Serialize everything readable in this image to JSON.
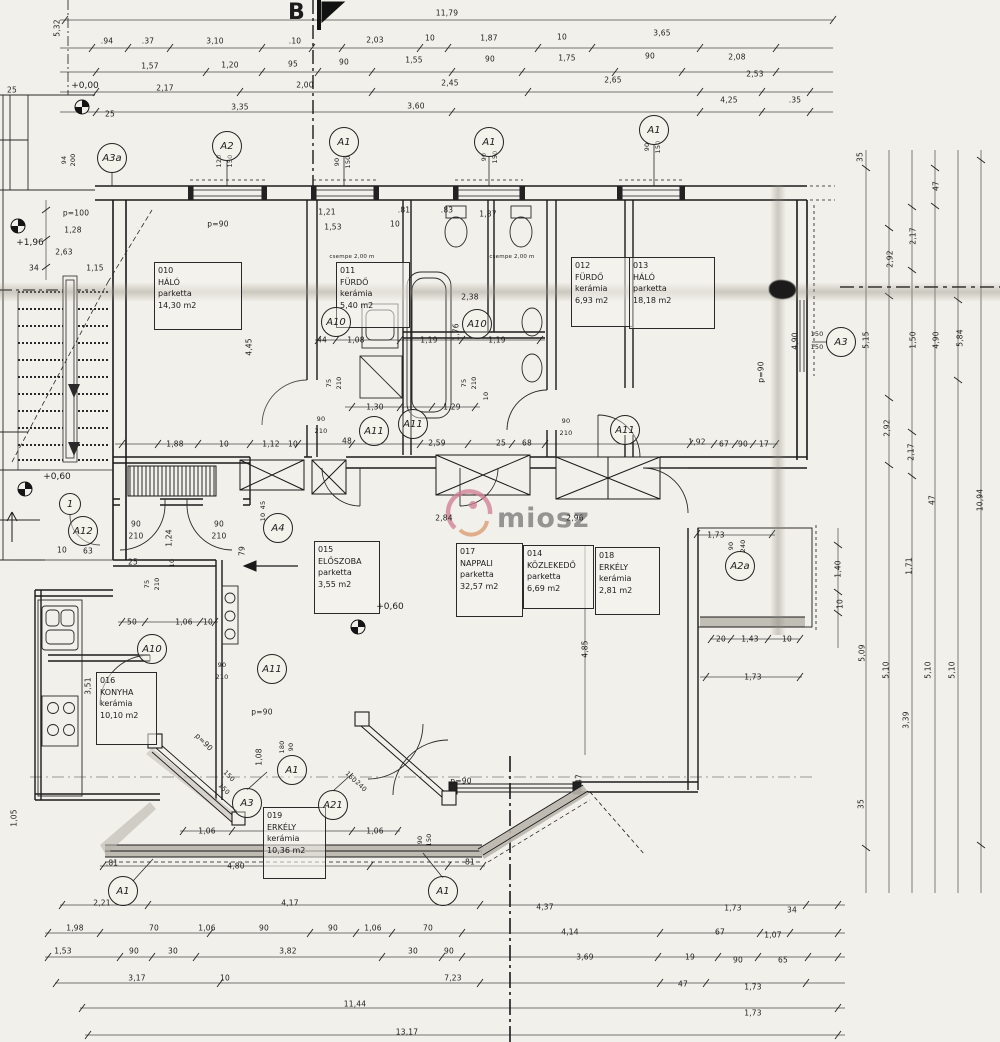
{
  "sheet": {
    "section_label": "B",
    "watermark_text": "miosz"
  },
  "rooms": [
    {
      "id": "010",
      "name": "HÁLÓ",
      "material": "parketta",
      "area": "14,30 m2",
      "x": 154,
      "y": 262,
      "w": 80,
      "h": 62
    },
    {
      "id": "011",
      "name": "FÜRDŐ",
      "material": "kerámia",
      "area": "5,40 m2",
      "x": 336,
      "y": 262,
      "w": 66,
      "h": 60
    },
    {
      "id": "012",
      "name": "FÜRDŐ",
      "material": "kerámia",
      "area": "6,93 m2",
      "x": 571,
      "y": 257,
      "w": 54,
      "h": 64
    },
    {
      "id": "013",
      "name": "HÁLÓ",
      "material": "parketta",
      "area": "18,18 m2",
      "x": 629,
      "y": 257,
      "w": 78,
      "h": 66
    },
    {
      "id": "015",
      "name": "ELŐSZOBA",
      "material": "parketta",
      "area": "3,55 m2",
      "x": 314,
      "y": 541,
      "w": 58,
      "h": 67
    },
    {
      "id": "017",
      "name": "NAPPALI",
      "material": "parketta",
      "area": "32,57 m2",
      "x": 456,
      "y": 543,
      "w": 59,
      "h": 68
    },
    {
      "id": "014",
      "name": "KÖZLEKEDŐ",
      "material": "parketta",
      "area": "6,69 m2",
      "x": 523,
      "y": 545,
      "w": 63,
      "h": 58
    },
    {
      "id": "018",
      "name": "ERKÉLY",
      "material": "kerámia",
      "area": "2,81 m2",
      "x": 595,
      "y": 547,
      "w": 57,
      "h": 62
    },
    {
      "id": "016",
      "name": "KONYHA",
      "material": "kerámia",
      "area": "10,10 m2",
      "x": 96,
      "y": 672,
      "w": 53,
      "h": 67
    },
    {
      "id": "019",
      "name": "ERKÉLY",
      "material": "kerámia",
      "area": "10,36 m2",
      "x": 263,
      "y": 807,
      "w": 55,
      "h": 66
    }
  ],
  "markers": [
    {
      "label": "A3a",
      "x": 112,
      "y": 158
    },
    {
      "label": "A2",
      "x": 227,
      "y": 146
    },
    {
      "label": "A1",
      "x": 344,
      "y": 142
    },
    {
      "label": "A1",
      "x": 489,
      "y": 142
    },
    {
      "label": "A1",
      "x": 654,
      "y": 130
    },
    {
      "label": "A3",
      "x": 841,
      "y": 342
    },
    {
      "label": "A10",
      "x": 336,
      "y": 322
    },
    {
      "label": "A10",
      "x": 477,
      "y": 324
    },
    {
      "label": "A11",
      "x": 374,
      "y": 431
    },
    {
      "label": "A11",
      "x": 413,
      "y": 424
    },
    {
      "label": "A11",
      "x": 625,
      "y": 430
    },
    {
      "label": "A10",
      "x": 152,
      "y": 649
    },
    {
      "label": "A11",
      "x": 272,
      "y": 669
    },
    {
      "label": "A12",
      "x": 83,
      "y": 531
    },
    {
      "label": "A4",
      "x": 278,
      "y": 528
    },
    {
      "label": "A2a",
      "x": 740,
      "y": 566
    },
    {
      "label": "1",
      "x": 70,
      "y": 504,
      "small": true
    },
    {
      "label": "A3",
      "x": 247,
      "y": 803
    },
    {
      "label": "A1",
      "x": 292,
      "y": 770
    },
    {
      "label": "A21",
      "x": 333,
      "y": 805
    },
    {
      "label": "A1",
      "x": 443,
      "y": 891
    },
    {
      "label": "A1",
      "x": 123,
      "y": 891
    }
  ],
  "levels": [
    {
      "text": "+0,00",
      "x": 85,
      "y": 86,
      "sx": 82,
      "sy": 107
    },
    {
      "text": "+1,96",
      "x": 30,
      "y": 243,
      "sx": 18,
      "sy": 226
    },
    {
      "text": "+0,60",
      "x": 57,
      "y": 477,
      "sx": 25,
      "sy": 489
    },
    {
      "text": "+0,60",
      "x": 390,
      "y": 607,
      "sx": 358,
      "sy": 627
    }
  ],
  "dims": [
    {
      "t": "11,79",
      "x": 447,
      "y": 13
    },
    {
      "t": ".94",
      "x": 107,
      "y": 41
    },
    {
      "t": ".37",
      "x": 148,
      "y": 41
    },
    {
      "t": "3,10",
      "x": 215,
      "y": 41
    },
    {
      "t": ".10",
      "x": 295,
      "y": 41
    },
    {
      "t": "2,03",
      "x": 375,
      "y": 40
    },
    {
      "t": "10",
      "x": 430,
      "y": 38
    },
    {
      "t": "1,87",
      "x": 489,
      "y": 38
    },
    {
      "t": "10",
      "x": 562,
      "y": 37
    },
    {
      "t": "3,65",
      "x": 662,
      "y": 33
    },
    {
      "t": "2,08",
      "x": 737,
      "y": 57
    },
    {
      "t": "1,57",
      "x": 150,
      "y": 66
    },
    {
      "t": "1,20",
      "x": 230,
      "y": 65
    },
    {
      "t": "95",
      "x": 293,
      "y": 64
    },
    {
      "t": "90",
      "x": 344,
      "y": 62
    },
    {
      "t": "1,55",
      "x": 414,
      "y": 60
    },
    {
      "t": "90",
      "x": 490,
      "y": 59
    },
    {
      "t": "1,75",
      "x": 567,
      "y": 58
    },
    {
      "t": "90",
      "x": 650,
      "y": 56
    },
    {
      "t": "2,53",
      "x": 755,
      "y": 74
    },
    {
      "t": "2,17",
      "x": 165,
      "y": 88
    },
    {
      "t": "2,00",
      "x": 305,
      "y": 85
    },
    {
      "t": "2,45",
      "x": 450,
      "y": 83
    },
    {
      "t": "2,65",
      "x": 613,
      "y": 80
    },
    {
      "t": "3,35",
      "x": 240,
      "y": 107
    },
    {
      "t": "3,60",
      "x": 416,
      "y": 106
    },
    {
      "t": "4,25",
      "x": 729,
      "y": 100
    },
    {
      "t": ".35",
      "x": 795,
      "y": 100
    },
    {
      "t": "5,32",
      "x": 57,
      "y": 28,
      "r": -90
    },
    {
      "t": "25",
      "x": 12,
      "y": 90
    },
    {
      "t": "25",
      "x": 110,
      "y": 114
    },
    {
      "t": "94",
      "x": 64,
      "y": 160,
      "r": -90,
      "s": 6.5
    },
    {
      "t": "200",
      "x": 73,
      "y": 160,
      "r": -90,
      "s": 6.5
    },
    {
      "t": "120",
      "x": 219,
      "y": 161,
      "r": -90,
      "s": 6.5
    },
    {
      "t": "150",
      "x": 230,
      "y": 161,
      "r": -90,
      "s": 6.5
    },
    {
      "t": "90",
      "x": 337,
      "y": 162,
      "r": -90,
      "s": 6.5
    },
    {
      "t": "150",
      "x": 348,
      "y": 162,
      "r": -90,
      "s": 6.5
    },
    {
      "t": "90",
      "x": 484,
      "y": 157,
      "r": -90,
      "s": 6.5
    },
    {
      "t": "150",
      "x": 495,
      "y": 157,
      "r": -90,
      "s": 6.5
    },
    {
      "t": "90",
      "x": 647,
      "y": 147,
      "r": -90,
      "s": 6.5
    },
    {
      "t": "150",
      "x": 658,
      "y": 147,
      "r": -90,
      "s": 6.5
    },
    {
      "t": "p=100",
      "x": 76,
      "y": 213
    },
    {
      "t": "1,28",
      "x": 73,
      "y": 230
    },
    {
      "t": "2,63",
      "x": 64,
      "y": 252
    },
    {
      "t": "34",
      "x": 34,
      "y": 268
    },
    {
      "t": "1,15",
      "x": 95,
      "y": 268
    },
    {
      "t": "p=90",
      "x": 218,
      "y": 224
    },
    {
      "t": "1,21",
      "x": 327,
      "y": 212
    },
    {
      "t": "1,53",
      "x": 333,
      "y": 227
    },
    {
      "t": ".81",
      "x": 404,
      "y": 210
    },
    {
      "t": "10",
      "x": 395,
      "y": 224
    },
    {
      "t": ".83",
      "x": 447,
      "y": 210
    },
    {
      "t": "1,87",
      "x": 488,
      "y": 214
    },
    {
      "t": "csempe 2,00 m",
      "x": 352,
      "y": 257,
      "s": 5.5
    },
    {
      "t": "csempe 2,00 m",
      "x": 512,
      "y": 257,
      "s": 5.5
    },
    {
      "t": "2,38",
      "x": 470,
      "y": 297
    },
    {
      "t": "1,76",
      "x": 456,
      "y": 332,
      "r": -90
    },
    {
      "t": "44",
      "x": 322,
      "y": 340
    },
    {
      "t": "1,08",
      "x": 356,
      "y": 340
    },
    {
      "t": "1,19",
      "x": 429,
      "y": 340
    },
    {
      "t": "1,19",
      "x": 497,
      "y": 340
    },
    {
      "t": "4,45",
      "x": 249,
      "y": 347,
      "r": -90
    },
    {
      "t": "75",
      "x": 329,
      "y": 383,
      "r": -90,
      "s": 6.5
    },
    {
      "t": "210",
      "x": 339,
      "y": 383,
      "r": -90,
      "s": 6.5
    },
    {
      "t": "75",
      "x": 464,
      "y": 383,
      "r": -90,
      "s": 6.5
    },
    {
      "t": "210",
      "x": 474,
      "y": 383,
      "r": -90,
      "s": 6.5
    },
    {
      "t": "1,30",
      "x": 375,
      "y": 407
    },
    {
      "t": "1,29",
      "x": 452,
      "y": 407
    },
    {
      "t": "10",
      "x": 486,
      "y": 396,
      "r": -90,
      "s": 6.5
    },
    {
      "t": "4,90",
      "x": 795,
      "y": 341,
      "r": -90
    },
    {
      "t": "150",
      "x": 817,
      "y": 334,
      "s": 6.5
    },
    {
      "t": "150",
      "x": 817,
      "y": 347,
      "s": 6.5
    },
    {
      "t": "p=90",
      "x": 761,
      "y": 372,
      "r": -90
    },
    {
      "t": "35",
      "x": 860,
      "y": 157,
      "r": -90
    },
    {
      "t": "47",
      "x": 936,
      "y": 186,
      "r": -90
    },
    {
      "t": "2,17",
      "x": 913,
      "y": 236,
      "r": -90
    },
    {
      "t": "2,92",
      "x": 890,
      "y": 259,
      "r": -90
    },
    {
      "t": "5,15",
      "x": 866,
      "y": 340,
      "r": -90
    },
    {
      "t": "1,50",
      "x": 913,
      "y": 340,
      "r": -90
    },
    {
      "t": "4,90",
      "x": 936,
      "y": 340,
      "r": -90
    },
    {
      "t": "5,84",
      "x": 960,
      "y": 338,
      "r": -90
    },
    {
      "t": "2,92",
      "x": 887,
      "y": 428,
      "r": -90
    },
    {
      "t": "2,17",
      "x": 911,
      "y": 452,
      "r": -90
    },
    {
      "t": "47",
      "x": 932,
      "y": 500,
      "r": -90
    },
    {
      "t": "10,94",
      "x": 980,
      "y": 500,
      "r": -90
    },
    {
      "t": "1,40",
      "x": 838,
      "y": 569,
      "r": -90
    },
    {
      "t": "10",
      "x": 840,
      "y": 604,
      "r": -90
    },
    {
      "t": "1,71",
      "x": 909,
      "y": 566,
      "r": -90
    },
    {
      "t": "5,09",
      "x": 862,
      "y": 653,
      "r": -90
    },
    {
      "t": "5,10",
      "x": 886,
      "y": 670,
      "r": -90
    },
    {
      "t": "3,39",
      "x": 906,
      "y": 720,
      "r": -90
    },
    {
      "t": "5,10",
      "x": 928,
      "y": 670,
      "r": -90
    },
    {
      "t": "5,10",
      "x": 952,
      "y": 670,
      "r": -90
    },
    {
      "t": "35",
      "x": 861,
      "y": 804,
      "r": -90
    },
    {
      "t": "1,88",
      "x": 175,
      "y": 444
    },
    {
      "t": "10",
      "x": 224,
      "y": 444
    },
    {
      "t": "1,12",
      "x": 271,
      "y": 444
    },
    {
      "t": "10",
      "x": 293,
      "y": 444
    },
    {
      "t": "90",
      "x": 321,
      "y": 419,
      "s": 6.5
    },
    {
      "t": "210",
      "x": 321,
      "y": 431,
      "s": 6.5
    },
    {
      "t": "48",
      "x": 347,
      "y": 441
    },
    {
      "t": "2,59",
      "x": 437,
      "y": 443
    },
    {
      "t": "25",
      "x": 501,
      "y": 443
    },
    {
      "t": "68",
      "x": 527,
      "y": 443
    },
    {
      "t": "90",
      "x": 566,
      "y": 421,
      "s": 6.5
    },
    {
      "t": "210",
      "x": 566,
      "y": 433,
      "s": 6.5
    },
    {
      "t": "1,92",
      "x": 697,
      "y": 442
    },
    {
      "t": "67",
      "x": 724,
      "y": 444
    },
    {
      "t": "90",
      "x": 743,
      "y": 444
    },
    {
      "t": "17",
      "x": 764,
      "y": 444
    },
    {
      "t": "2,84",
      "x": 444,
      "y": 518
    },
    {
      "t": "2,96",
      "x": 575,
      "y": 518
    },
    {
      "t": "45",
      "x": 263,
      "y": 505,
      "r": -90,
      "s": 6.5
    },
    {
      "t": "10",
      "x": 263,
      "y": 517,
      "r": -90,
      "s": 6.5
    },
    {
      "t": "90",
      "x": 136,
      "y": 524
    },
    {
      "t": "210",
      "x": 136,
      "y": 536
    },
    {
      "t": "90",
      "x": 219,
      "y": 524
    },
    {
      "t": "210",
      "x": 219,
      "y": 536
    },
    {
      "t": "25",
      "x": 133,
      "y": 562
    },
    {
      "t": "1,24",
      "x": 169,
      "y": 538,
      "r": -90
    },
    {
      "t": "79",
      "x": 242,
      "y": 551,
      "r": -90
    },
    {
      "t": "10",
      "x": 172,
      "y": 563,
      "r": -90,
      "s": 6.5
    },
    {
      "t": "75",
      "x": 147,
      "y": 584,
      "r": -90,
      "s": 6.5
    },
    {
      "t": "210",
      "x": 157,
      "y": 584,
      "r": -90,
      "s": 6.5
    },
    {
      "t": "50",
      "x": 132,
      "y": 622
    },
    {
      "t": "1,06",
      "x": 184,
      "y": 622
    },
    {
      "t": "10",
      "x": 208,
      "y": 622
    },
    {
      "t": "10",
      "x": 62,
      "y": 550
    },
    {
      "t": "63",
      "x": 88,
      "y": 551
    },
    {
      "t": "3,51",
      "x": 88,
      "y": 686,
      "r": -90
    },
    {
      "t": "90",
      "x": 222,
      "y": 665,
      "s": 6.5
    },
    {
      "t": "210",
      "x": 222,
      "y": 677,
      "s": 6.5
    },
    {
      "t": "p=90",
      "x": 262,
      "y": 712
    },
    {
      "t": "p=90",
      "x": 204,
      "y": 742,
      "r": 45
    },
    {
      "t": "1,08",
      "x": 259,
      "y": 757,
      "r": -90
    },
    {
      "t": "180",
      "x": 282,
      "y": 747,
      "r": -90,
      "s": 6.5
    },
    {
      "t": "90",
      "x": 291,
      "y": 747,
      "r": -90,
      "s": 6.5
    },
    {
      "t": "150",
      "x": 229,
      "y": 776,
      "r": 45,
      "s": 6.5
    },
    {
      "t": "150",
      "x": 224,
      "y": 789,
      "r": 45,
      "s": 6.5
    },
    {
      "t": "160",
      "x": 351,
      "y": 777,
      "r": 45,
      "s": 6.5
    },
    {
      "t": "240",
      "x": 361,
      "y": 786,
      "r": 45,
      "s": 6.5
    },
    {
      "t": "p=90",
      "x": 461,
      "y": 781
    },
    {
      "t": "1,06",
      "x": 207,
      "y": 831
    },
    {
      "t": "1,06",
      "x": 375,
      "y": 831
    },
    {
      "t": "4,80",
      "x": 236,
      "y": 866
    },
    {
      "t": "81",
      "x": 470,
      "y": 862
    },
    {
      "t": ".81",
      "x": 112,
      "y": 863
    },
    {
      "t": "1,05",
      "x": 14,
      "y": 818,
      "r": -90
    },
    {
      "t": "90",
      "x": 420,
      "y": 840,
      "r": -90,
      "s": 6.5
    },
    {
      "t": "150",
      "x": 429,
      "y": 840,
      "r": -90,
      "s": 6.5
    },
    {
      "t": "47",
      "x": 579,
      "y": 779,
      "r": -90
    },
    {
      "t": "1,73",
      "x": 716,
      "y": 535
    },
    {
      "t": "90",
      "x": 731,
      "y": 546,
      "r": -90,
      "s": 6.5
    },
    {
      "t": "240",
      "x": 743,
      "y": 546,
      "r": -90,
      "s": 6.5
    },
    {
      "t": "20",
      "x": 721,
      "y": 639
    },
    {
      "t": "1,43",
      "x": 750,
      "y": 639
    },
    {
      "t": "10",
      "x": 787,
      "y": 639
    },
    {
      "t": "1,73",
      "x": 753,
      "y": 677
    },
    {
      "t": "4,85",
      "x": 585,
      "y": 649,
      "r": -90
    },
    {
      "t": "2,21",
      "x": 102,
      "y": 903
    },
    {
      "t": "4,17",
      "x": 290,
      "y": 903
    },
    {
      "t": "4,37",
      "x": 545,
      "y": 907
    },
    {
      "t": "1,73",
      "x": 733,
      "y": 908
    },
    {
      "t": "34",
      "x": 792,
      "y": 910
    },
    {
      "t": "1,98",
      "x": 75,
      "y": 928
    },
    {
      "t": "70",
      "x": 154,
      "y": 928
    },
    {
      "t": "1,06",
      "x": 207,
      "y": 928
    },
    {
      "t": "90",
      "x": 264,
      "y": 928
    },
    {
      "t": "90",
      "x": 333,
      "y": 928
    },
    {
      "t": "1,06",
      "x": 373,
      "y": 928
    },
    {
      "t": "70",
      "x": 428,
      "y": 928
    },
    {
      "t": "4,14",
      "x": 570,
      "y": 932
    },
    {
      "t": "67",
      "x": 720,
      "y": 932
    },
    {
      "t": "1,07",
      "x": 773,
      "y": 935
    },
    {
      "t": "1,53",
      "x": 63,
      "y": 951
    },
    {
      "t": "90",
      "x": 134,
      "y": 951
    },
    {
      "t": "30",
      "x": 173,
      "y": 951
    },
    {
      "t": "3,82",
      "x": 288,
      "y": 951
    },
    {
      "t": "30",
      "x": 413,
      "y": 951
    },
    {
      "t": "90",
      "x": 449,
      "y": 951
    },
    {
      "t": "3,69",
      "x": 585,
      "y": 957
    },
    {
      "t": "19",
      "x": 690,
      "y": 957
    },
    {
      "t": "90",
      "x": 738,
      "y": 960
    },
    {
      "t": "65",
      "x": 783,
      "y": 960
    },
    {
      "t": "3,17",
      "x": 137,
      "y": 978
    },
    {
      "t": "10",
      "x": 225,
      "y": 978
    },
    {
      "t": "7,23",
      "x": 453,
      "y": 978
    },
    {
      "t": "47",
      "x": 683,
      "y": 984
    },
    {
      "t": "1,73",
      "x": 753,
      "y": 987
    },
    {
      "t": "11,44",
      "x": 355,
      "y": 1004
    },
    {
      "t": "1,73",
      "x": 753,
      "y": 1013
    },
    {
      "t": "13,17",
      "x": 407,
      "y": 1032
    }
  ]
}
